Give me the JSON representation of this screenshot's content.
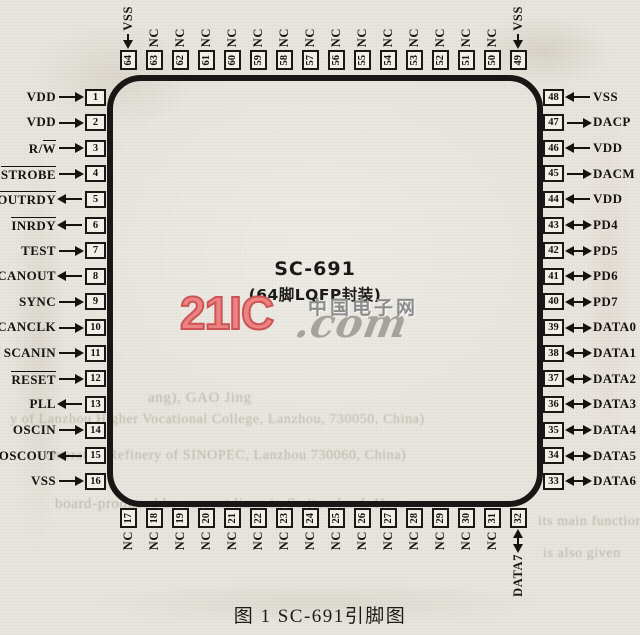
{
  "figure": {
    "chip_name": "SC-691",
    "package": "(64脚LQFP封装)",
    "caption": "图 1  SC-691引脚图"
  },
  "watermark": {
    "logo": "21IC",
    "suffix": ".com",
    "site_name": "中国电子网",
    "logo_color": "#ec8383",
    "gray_color": "#8c8c8c"
  },
  "pins": {
    "left": [
      {
        "num": 1,
        "label": "VDD",
        "dir": "in",
        "ovl": ""
      },
      {
        "num": 2,
        "label": "VDD",
        "dir": "in",
        "ovl": ""
      },
      {
        "num": 3,
        "label": "R/W",
        "dir": "in",
        "ovl": "W"
      },
      {
        "num": 4,
        "label": "STROBE",
        "dir": "in",
        "ovl": "*"
      },
      {
        "num": 5,
        "label": "OUTRDY",
        "dir": "out",
        "ovl": "*"
      },
      {
        "num": 6,
        "label": "INRDY",
        "dir": "out",
        "ovl": "*"
      },
      {
        "num": 7,
        "label": "TEST",
        "dir": "in",
        "ovl": ""
      },
      {
        "num": 8,
        "label": "SCANOUT",
        "dir": "out",
        "ovl": ""
      },
      {
        "num": 9,
        "label": "SYNC",
        "dir": "in",
        "ovl": ""
      },
      {
        "num": 10,
        "label": "SCANCLK",
        "dir": "in",
        "ovl": ""
      },
      {
        "num": 11,
        "label": "SCANIN",
        "dir": "in",
        "ovl": ""
      },
      {
        "num": 12,
        "label": "RESET",
        "dir": "in",
        "ovl": "*"
      },
      {
        "num": 13,
        "label": "PLL",
        "dir": "out",
        "ovl": ""
      },
      {
        "num": 14,
        "label": "OSCIN",
        "dir": "in",
        "ovl": ""
      },
      {
        "num": 15,
        "label": "OSCOUT",
        "dir": "out",
        "ovl": ""
      },
      {
        "num": 16,
        "label": "VSS",
        "dir": "in",
        "ovl": ""
      }
    ],
    "right": [
      {
        "num": 48,
        "label": "VSS",
        "dir": "in",
        "ovl": ""
      },
      {
        "num": 47,
        "label": "DACP",
        "dir": "out",
        "ovl": ""
      },
      {
        "num": 46,
        "label": "VDD",
        "dir": "in",
        "ovl": ""
      },
      {
        "num": 45,
        "label": "DACM",
        "dir": "out",
        "ovl": ""
      },
      {
        "num": 44,
        "label": "VDD",
        "dir": "in",
        "ovl": ""
      },
      {
        "num": 43,
        "label": "PD4",
        "dir": "bidir",
        "ovl": ""
      },
      {
        "num": 42,
        "label": "PD5",
        "dir": "bidir",
        "ovl": ""
      },
      {
        "num": 41,
        "label": "PD6",
        "dir": "bidir",
        "ovl": ""
      },
      {
        "num": 40,
        "label": "PD7",
        "dir": "bidir",
        "ovl": ""
      },
      {
        "num": 39,
        "label": "DATA0",
        "dir": "bidir",
        "ovl": ""
      },
      {
        "num": 38,
        "label": "DATA1",
        "dir": "bidir",
        "ovl": ""
      },
      {
        "num": 37,
        "label": "DATA2",
        "dir": "bidir",
        "ovl": ""
      },
      {
        "num": 36,
        "label": "DATA3",
        "dir": "bidir",
        "ovl": ""
      },
      {
        "num": 35,
        "label": "DATA4",
        "dir": "bidir",
        "ovl": ""
      },
      {
        "num": 34,
        "label": "DATA5",
        "dir": "bidir",
        "ovl": ""
      },
      {
        "num": 33,
        "label": "DATA6",
        "dir": "bidir",
        "ovl": ""
      }
    ],
    "top": [
      {
        "num": 64,
        "label": "VSS",
        "dir": "in",
        "ovl": ""
      },
      {
        "num": 63,
        "label": "NC",
        "dir": "none",
        "ovl": ""
      },
      {
        "num": 62,
        "label": "NC",
        "dir": "none",
        "ovl": ""
      },
      {
        "num": 61,
        "label": "NC",
        "dir": "none",
        "ovl": ""
      },
      {
        "num": 60,
        "label": "NC",
        "dir": "none",
        "ovl": ""
      },
      {
        "num": 59,
        "label": "NC",
        "dir": "none",
        "ovl": ""
      },
      {
        "num": 58,
        "label": "NC",
        "dir": "none",
        "ovl": ""
      },
      {
        "num": 57,
        "label": "NC",
        "dir": "none",
        "ovl": ""
      },
      {
        "num": 56,
        "label": "NC",
        "dir": "none",
        "ovl": ""
      },
      {
        "num": 55,
        "label": "NC",
        "dir": "none",
        "ovl": ""
      },
      {
        "num": 54,
        "label": "NC",
        "dir": "none",
        "ovl": ""
      },
      {
        "num": 53,
        "label": "NC",
        "dir": "none",
        "ovl": ""
      },
      {
        "num": 52,
        "label": "NC",
        "dir": "none",
        "ovl": ""
      },
      {
        "num": 51,
        "label": "NC",
        "dir": "none",
        "ovl": ""
      },
      {
        "num": 50,
        "label": "NC",
        "dir": "none",
        "ovl": ""
      },
      {
        "num": 49,
        "label": "VSS",
        "dir": "in",
        "ovl": ""
      }
    ],
    "bottom": [
      {
        "num": 17,
        "label": "NC",
        "dir": "none",
        "ovl": ""
      },
      {
        "num": 18,
        "label": "NC",
        "dir": "none",
        "ovl": ""
      },
      {
        "num": 19,
        "label": "NC",
        "dir": "none",
        "ovl": ""
      },
      {
        "num": 20,
        "label": "NC",
        "dir": "none",
        "ovl": ""
      },
      {
        "num": 21,
        "label": "NC",
        "dir": "none",
        "ovl": ""
      },
      {
        "num": 22,
        "label": "NC",
        "dir": "none",
        "ovl": ""
      },
      {
        "num": 23,
        "label": "NC",
        "dir": "none",
        "ovl": ""
      },
      {
        "num": 24,
        "label": "NC",
        "dir": "none",
        "ovl": ""
      },
      {
        "num": 25,
        "label": "NC",
        "dir": "none",
        "ovl": ""
      },
      {
        "num": 26,
        "label": "NC",
        "dir": "none",
        "ovl": ""
      },
      {
        "num": 27,
        "label": "NC",
        "dir": "none",
        "ovl": ""
      },
      {
        "num": 28,
        "label": "NC",
        "dir": "none",
        "ovl": ""
      },
      {
        "num": 29,
        "label": "NC",
        "dir": "none",
        "ovl": ""
      },
      {
        "num": 30,
        "label": "NC",
        "dir": "none",
        "ovl": ""
      },
      {
        "num": 31,
        "label": "NC",
        "dir": "none",
        "ovl": ""
      },
      {
        "num": 32,
        "label": "DATA7",
        "dir": "bidir",
        "ovl": ""
      }
    ]
  },
  "bleedthrough": {
    "fragments": [
      {
        "text": "ang),  GAO Jing",
        "x": 148,
        "y": 390,
        "size": 15
      },
      {
        "text": "y of Lanzhou Higher Vocational College, Lanzhou, 730050, China)",
        "x": 10,
        "y": 412,
        "size": 14
      },
      {
        "text": "omerator, Refinery of SINOPEC, Lanzhou 730060, China)",
        "x": 45,
        "y": 448,
        "size": 14
      },
      {
        "text": "board-produced by current lines in Switzerland. Here",
        "x": 55,
        "y": 496,
        "size": 15
      },
      {
        "text": "its main functions",
        "x": 538,
        "y": 514,
        "size": 14
      },
      {
        "text": "is also given",
        "x": 543,
        "y": 546,
        "size": 14
      }
    ]
  }
}
